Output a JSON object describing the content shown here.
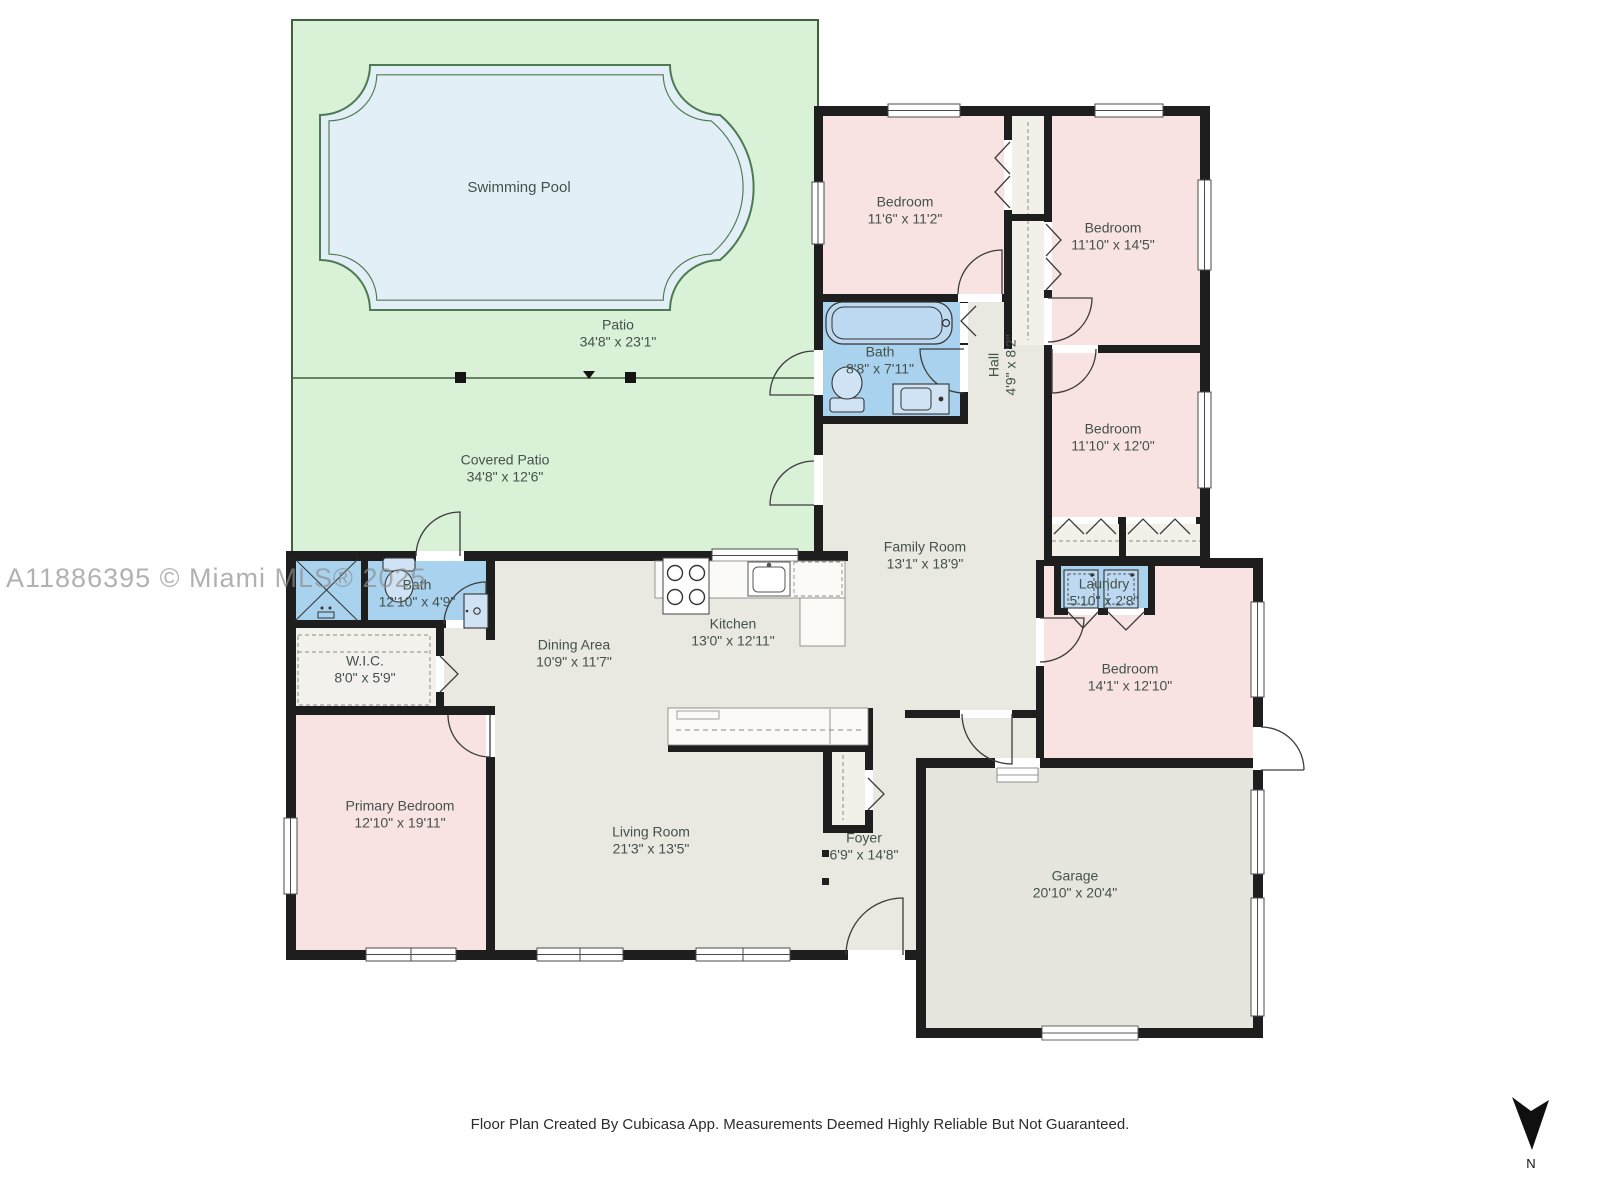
{
  "annotations": {
    "watermark": "A11886395 © Miami MLS® 2025",
    "footer": "Floor Plan Created By Cubicasa App. Measurements Deemed Highly Reliable But Not Guaranteed.",
    "compass": "N"
  },
  "colors": {
    "patio_green": "#d9f1d6",
    "pool_blue": "#e3eff7",
    "room_pink": "#f8e3e2",
    "wet_room_blue": "#a9d2ee",
    "floor_gray": "#e9e8e1",
    "closet_floor": "#f2f0e9",
    "wall_black": "#1e1e1e"
  },
  "rooms": {
    "swimming_pool": {
      "name": "Swimming Pool",
      "dims": ""
    },
    "patio": {
      "name": "Patio",
      "dims": "34'8\" x 23'1\""
    },
    "covered_patio": {
      "name": "Covered Patio",
      "dims": "34'8\" x 12'6\""
    },
    "bedroom_1": {
      "name": "Bedroom",
      "dims": "11'6\" x 11'2\""
    },
    "bedroom_2": {
      "name": "Bedroom",
      "dims": "11'10\" x 14'5\""
    },
    "bath_main": {
      "name": "Bath",
      "dims": "8'8\" x 7'11\""
    },
    "hall": {
      "name": "Hall",
      "dims": "4'9\" x 8'2\""
    },
    "bedroom_3": {
      "name": "Bedroom",
      "dims": "11'10\" x 12'0\""
    },
    "family_room": {
      "name": "Family Room",
      "dims": "13'1\" x 18'9\""
    },
    "laundry": {
      "name": "Laundry",
      "dims": "5'10\" x 2'8\""
    },
    "bedroom_4": {
      "name": "Bedroom",
      "dims": "14'1\" x 12'10\""
    },
    "bath_primary": {
      "name": "Bath",
      "dims": "12'10\" x 4'9\""
    },
    "wic": {
      "name": "W.I.C.",
      "dims": "8'0\" x 5'9\""
    },
    "dining_area": {
      "name": "Dining Area",
      "dims": "10'9\" x 11'7\""
    },
    "kitchen": {
      "name": "Kitchen",
      "dims": "13'0\" x 12'11\""
    },
    "primary_bedroom": {
      "name": "Primary Bedroom",
      "dims": "12'10\" x 19'11\""
    },
    "living_room": {
      "name": "Living Room",
      "dims": "21'3\" x 13'5\""
    },
    "foyer": {
      "name": "Foyer",
      "dims": "6'9\" x 14'8\""
    },
    "garage": {
      "name": "Garage",
      "dims": "20'10\" x 20'4\""
    }
  }
}
